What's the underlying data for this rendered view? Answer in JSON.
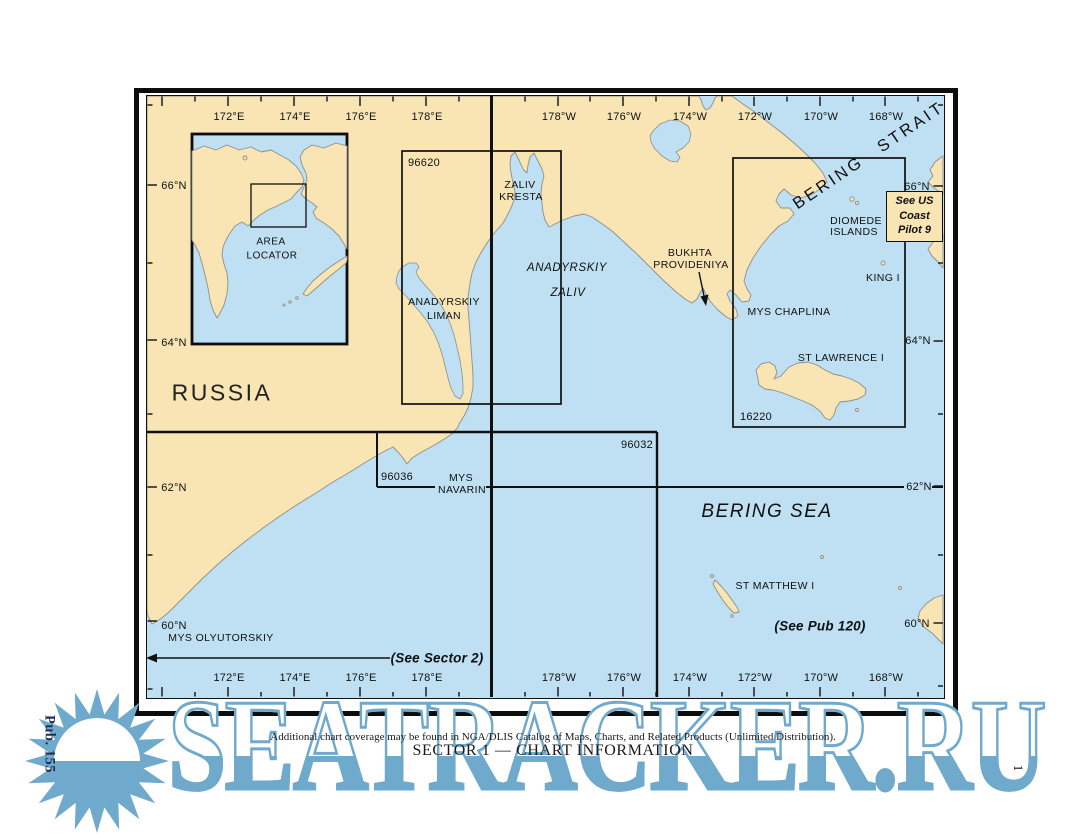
{
  "page": {
    "publication": "Pub. 155",
    "page_number": "1",
    "footer_note": "Additional chart coverage may be found in NGA/DLIS Catalog of Maps, Charts, and Related Products (Unlimited Distribution).",
    "footer_title": "SECTOR 1 — CHART INFORMATION",
    "watermark": "SEATRACKER.RU"
  },
  "map": {
    "colors": {
      "land": "#F8E5B3",
      "sea": "#BFE0F2",
      "watermark_blue": "#6FA9CC",
      "frame": "#0d0d0d"
    },
    "inset": {
      "line1": "AREA",
      "line2": "LOCATOR"
    },
    "regions": {
      "russia": "RUSSIA",
      "bering_sea": "BERING SEA",
      "bering_strait": "BERING STRAIT"
    },
    "places": {
      "zaliv_kresta": [
        "ZALIV",
        "KRESTA"
      ],
      "anadyrskiy_zaliv": [
        "ANADYRSKIY",
        "ZALIV"
      ],
      "anadyrskiy_liman": [
        "ANADYRSKIY",
        "LIMAN"
      ],
      "bukhta_provideniya": [
        "BUKHTA",
        "PROVIDENIYA"
      ],
      "mys_chaplina": "MYS CHAPLINA",
      "diomede_islands": [
        "DIOMEDE",
        "ISLANDS"
      ],
      "king_island": "KING I",
      "st_lawrence": "ST LAWRENCE I",
      "st_matthew": "ST MATTHEW I",
      "mys_navarin": [
        "MYS",
        "NAVARIN"
      ],
      "mys_olyutorskiy": "MYS OLYUTORSKIY"
    },
    "chart_numbers": {
      "c96620": "96620",
      "c96036": "96036",
      "c96032": "96032",
      "c16220": "16220"
    },
    "notes": {
      "coast_pilot": [
        "See US",
        "Coast",
        "Pilot 9"
      ],
      "see_sector_2": "(See Sector 2)",
      "see_pub_120": "(See Pub 120)"
    },
    "axes": {
      "top": [
        "172°E",
        "174°E",
        "176°E",
        "178°E",
        "178°W",
        "176°W",
        "174°W",
        "172°W",
        "170°W",
        "168°W"
      ],
      "bottom": [
        "172°E",
        "174°E",
        "176°E",
        "178°E",
        "178°W",
        "176°W",
        "174°W",
        "172°W",
        "170°W",
        "168°W"
      ],
      "left": [
        "66°N",
        "64°N",
        "62°N",
        "60°N"
      ],
      "right": [
        "66°N",
        "64°N",
        "62°N",
        "60°N"
      ]
    }
  }
}
